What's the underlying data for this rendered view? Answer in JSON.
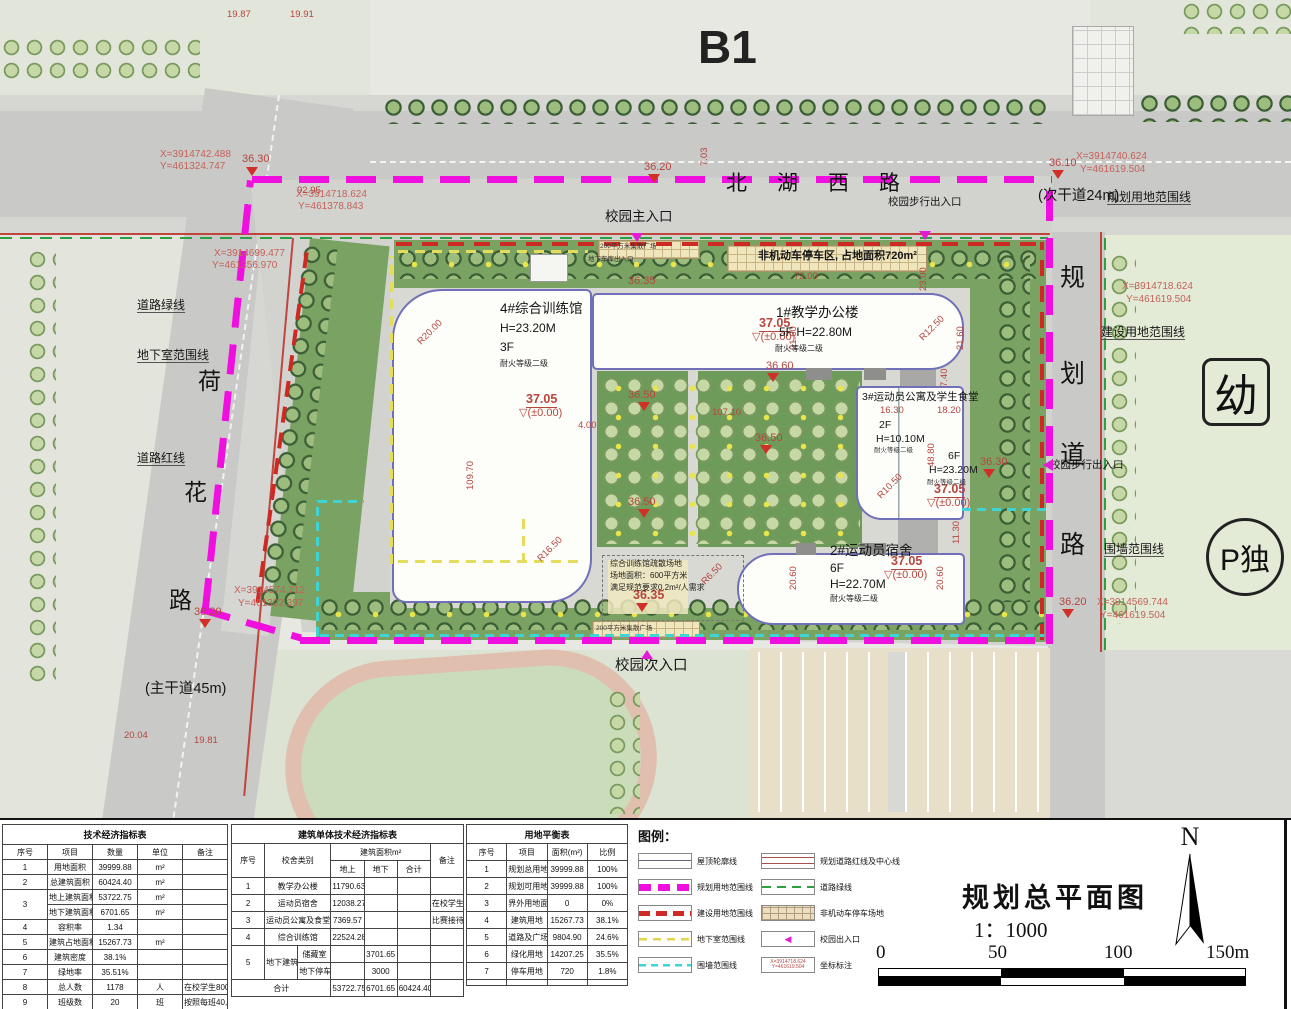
{
  "sheet": {
    "block_label": "B1",
    "title": "规划总平面图",
    "scale": "1：1000",
    "north": "N",
    "scale_ticks": [
      "0",
      "50",
      "100",
      "150m"
    ]
  },
  "plan": {
    "roads": {
      "north_name": "北湖西路",
      "north_note": "(次干道24m)",
      "west_note": "(主干道45m)"
    },
    "marks": {
      "kindergarten": "幼",
      "parking_island": "P独"
    },
    "annotations": [
      {
        "t": "X=3914742.488",
        "x": 160,
        "y": 150,
        "c": "rc"
      },
      {
        "t": "Y=461324.747",
        "x": 160,
        "y": 162,
        "c": "rc"
      },
      {
        "t": "X=3914718.624",
        "x": 296,
        "y": 190,
        "c": "rc"
      },
      {
        "t": "Y=461378.843",
        "x": 298,
        "y": 202,
        "c": "rc"
      },
      {
        "t": "X=3914699.477",
        "x": 214,
        "y": 249,
        "c": "rc"
      },
      {
        "t": "Y=461356.970",
        "x": 212,
        "y": 261,
        "c": "rc"
      },
      {
        "t": "X=3914740.624",
        "x": 1076,
        "y": 152,
        "c": "rc"
      },
      {
        "t": "Y=461619.504",
        "x": 1080,
        "y": 165,
        "c": "rc"
      },
      {
        "t": "X=3914718.624",
        "x": 1122,
        "y": 282,
        "c": "rc"
      },
      {
        "t": "Y=461619.504",
        "x": 1126,
        "y": 295,
        "c": "rc"
      },
      {
        "t": "X=3914574.712",
        "x": 234,
        "y": 586,
        "c": "rc"
      },
      {
        "t": "Y=461302.397",
        "x": 238,
        "y": 599,
        "c": "rc"
      },
      {
        "t": "X=3914569.744",
        "x": 1097,
        "y": 598,
        "c": "rc"
      },
      {
        "t": "Y=461619.504",
        "x": 1100,
        "y": 611,
        "c": "rc"
      },
      {
        "t": "36.30",
        "x": 242,
        "y": 154,
        "c": "r2"
      },
      {
        "t": "36.10",
        "x": 1049,
        "y": 158,
        "c": "r2"
      },
      {
        "t": "36.20",
        "x": 644,
        "y": 162,
        "c": "r2"
      },
      {
        "t": "36.60",
        "x": 766,
        "y": 361,
        "c": "r2"
      },
      {
        "t": "36.50",
        "x": 628,
        "y": 390,
        "c": "r2"
      },
      {
        "t": "36.50",
        "x": 755,
        "y": 433,
        "c": "r2"
      },
      {
        "t": "36.50",
        "x": 628,
        "y": 497,
        "c": "r2"
      },
      {
        "t": "36.30",
        "x": 980,
        "y": 457,
        "c": "r2"
      },
      {
        "t": "36.20",
        "x": 1059,
        "y": 597,
        "c": "r2"
      },
      {
        "t": "36.20",
        "x": 194,
        "y": 607,
        "c": "r2"
      },
      {
        "t": "36.35",
        "x": 628,
        "y": 276,
        "c": "r2"
      },
      {
        "t": "36.35",
        "x": 633,
        "y": 589,
        "c": "rb"
      },
      {
        "t": "37.05",
        "x": 526,
        "y": 393,
        "c": "rb u"
      },
      {
        "t": "▽(±0.00)",
        "x": 519,
        "y": 408,
        "c": "r2"
      },
      {
        "t": "37.05",
        "x": 759,
        "y": 317,
        "c": "rb u"
      },
      {
        "t": "▽(±0.00)",
        "x": 752,
        "y": 332,
        "c": "r2"
      },
      {
        "t": "37.05",
        "x": 934,
        "y": 483,
        "c": "rb u"
      },
      {
        "t": "▽(±0.00)",
        "x": 927,
        "y": 498,
        "c": "r2"
      },
      {
        "t": "37.05",
        "x": 891,
        "y": 555,
        "c": "rb u"
      },
      {
        "t": "▽(±0.00)",
        "x": 884,
        "y": 570,
        "c": "r2"
      },
      {
        "t": "19.87",
        "x": 227,
        "y": 10,
        "c": "r"
      },
      {
        "t": "19.91",
        "x": 290,
        "y": 10,
        "c": "r"
      },
      {
        "t": "92.95",
        "x": 297,
        "y": 186,
        "c": "r"
      },
      {
        "t": "7.03",
        "x": 700,
        "y": 166,
        "c": "r v"
      },
      {
        "t": "72.00",
        "x": 794,
        "y": 272,
        "c": "r"
      },
      {
        "t": "109.70",
        "x": 466,
        "y": 490,
        "c": "r v"
      },
      {
        "t": "21.60",
        "x": 789,
        "y": 350,
        "c": "r v"
      },
      {
        "t": "21.60",
        "x": 956,
        "y": 350,
        "c": "r v"
      },
      {
        "t": "7.40",
        "x": 940,
        "y": 387,
        "c": "r v"
      },
      {
        "t": "R20.00",
        "x": 416,
        "y": 340,
        "c": "r r45"
      },
      {
        "t": "R12.50",
        "x": 918,
        "y": 336,
        "c": "r r45"
      },
      {
        "t": "R16.50",
        "x": 536,
        "y": 557,
        "c": "r r45"
      },
      {
        "t": "R10.50",
        "x": 876,
        "y": 494,
        "c": "r r45"
      },
      {
        "t": "R6.50",
        "x": 700,
        "y": 580,
        "c": "r r45"
      },
      {
        "t": "16.30",
        "x": 880,
        "y": 406,
        "c": "r"
      },
      {
        "t": "18.20",
        "x": 937,
        "y": 406,
        "c": "r"
      },
      {
        "t": "48.80",
        "x": 927,
        "y": 467,
        "c": "r v"
      },
      {
        "t": "11.30",
        "x": 952,
        "y": 544,
        "c": "r v"
      },
      {
        "t": "20.60",
        "x": 789,
        "y": 590,
        "c": "r v"
      },
      {
        "t": "20.60",
        "x": 936,
        "y": 590,
        "c": "r v"
      },
      {
        "t": "20.04",
        "x": 124,
        "y": 731,
        "c": "r"
      },
      {
        "t": "19.81",
        "x": 194,
        "y": 736,
        "c": "r"
      },
      {
        "t": "107.10",
        "x": 712,
        "y": 408,
        "c": "r"
      },
      {
        "t": "4.00",
        "x": 578,
        "y": 421,
        "c": "r"
      },
      {
        "t": "23.00",
        "x": 919,
        "y": 291,
        "c": "r v"
      },
      {
        "t": "规划用地范围线",
        "x": 1107,
        "y": 191,
        "c": "k ldr",
        "n": "label-plan-boundary"
      },
      {
        "t": "校园步行出入口",
        "x": 888,
        "y": 197,
        "c": "k s10",
        "n": "label-pedestrian-entrance"
      },
      {
        "t": "校园主入口",
        "x": 605,
        "y": 210,
        "c": "k s13",
        "n": "label-main-entrance"
      },
      {
        "t": "(次干道24m)",
        "x": 1038,
        "y": 189,
        "c": "k s14",
        "n": "label-road-note"
      },
      {
        "t": "道路绿线",
        "x": 137,
        "y": 299,
        "c": "k ldr",
        "n": "label-road-greenline"
      },
      {
        "t": "地下室范围线",
        "x": 137,
        "y": 349,
        "c": "k ldr",
        "n": "label-basement-boundary"
      },
      {
        "t": "道路红线",
        "x": 137,
        "y": 452,
        "c": "k ldr",
        "n": "label-road-redline"
      },
      {
        "t": "(主干道45m)",
        "x": 145,
        "y": 682,
        "c": "k s14",
        "n": "label-road-note"
      },
      {
        "t": "建设用地范围线",
        "x": 1101,
        "y": 326,
        "c": "k ldr",
        "n": "label-construction-boundary"
      },
      {
        "t": "校园步行出入口",
        "x": 1050,
        "y": 460,
        "c": "k s10",
        "n": "label-pedestrian-entrance"
      },
      {
        "t": "围墙范围线",
        "x": 1104,
        "y": 543,
        "c": "k ldr",
        "n": "label-wall-boundary"
      },
      {
        "t": "校园次入口",
        "x": 615,
        "y": 659,
        "c": "k s14",
        "n": "label-secondary-entrance"
      },
      {
        "t": "荷",
        "x": 198,
        "y": 370,
        "c": "c24"
      },
      {
        "t": "花",
        "x": 184,
        "y": 481,
        "c": "c24"
      },
      {
        "t": "路",
        "x": 169,
        "y": 589,
        "c": "c24"
      },
      {
        "t": "规",
        "x": 1060,
        "y": 266,
        "c": "c26"
      },
      {
        "t": "划",
        "x": 1060,
        "y": 362,
        "c": "c26"
      },
      {
        "t": "道",
        "x": 1060,
        "y": 443,
        "c": "c26"
      },
      {
        "t": "路",
        "x": 1060,
        "y": 533,
        "c": "c26"
      },
      {
        "t": "200平方米集散广场",
        "x": 600,
        "y": 244,
        "c": "t7"
      },
      {
        "t": "地下车库出入口",
        "x": 588,
        "y": 257,
        "c": "t7"
      },
      {
        "t": "非机动车停车区, 占地面积720m²",
        "x": 758,
        "y": 251,
        "c": "k s11",
        "n": "label-bike-parking"
      },
      {
        "t": "200平方米集散广场",
        "x": 596,
        "y": 626,
        "c": "t7"
      },
      {
        "t": "综合训练馆疏散场地",
        "x": 610,
        "y": 560,
        "c": "s"
      },
      {
        "t": "场地面积：600平方米",
        "x": 610,
        "y": 572,
        "c": "s"
      },
      {
        "t": "满足规范要求0.2m²/人需求",
        "x": 610,
        "y": 584,
        "c": "s"
      },
      {
        "t": "4#综合训练馆",
        "x": 500,
        "y": 302,
        "c": "k s13",
        "n": "building-label"
      },
      {
        "t": "H=23.20M",
        "x": 500,
        "y": 322,
        "c": "k s12"
      },
      {
        "t": "3F",
        "x": 500,
        "y": 341,
        "c": "k s12"
      },
      {
        "t": "耐火等级二级",
        "x": 500,
        "y": 360,
        "c": "s"
      },
      {
        "t": "1#教学办公楼",
        "x": 776,
        "y": 306,
        "c": "k s13",
        "n": "building-label"
      },
      {
        "t": "5F  H=22.80M",
        "x": 779,
        "y": 326,
        "c": "k s12"
      },
      {
        "t": "耐火等级二级",
        "x": 775,
        "y": 345,
        "c": "s"
      },
      {
        "t": "3#运动员公寓及学生食堂",
        "x": 862,
        "y": 392,
        "c": "k s10",
        "n": "building-label"
      },
      {
        "t": "2F",
        "x": 879,
        "y": 420,
        "c": "k s10"
      },
      {
        "t": "H=10.10M",
        "x": 876,
        "y": 434,
        "c": "k s10"
      },
      {
        "t": "耐火等级二级",
        "x": 874,
        "y": 448,
        "c": "t7"
      },
      {
        "t": "6F",
        "x": 948,
        "y": 451,
        "c": "k s10"
      },
      {
        "t": "H=23.20M",
        "x": 929,
        "y": 465,
        "c": "k s10"
      },
      {
        "t": "耐火等级二级",
        "x": 927,
        "y": 480,
        "c": "t7"
      },
      {
        "t": "2#运动员宿舍",
        "x": 830,
        "y": 544,
        "c": "k s13",
        "n": "building-label"
      },
      {
        "t": "6F",
        "x": 830,
        "y": 562,
        "c": "k s12"
      },
      {
        "t": "H=22.70M",
        "x": 830,
        "y": 578,
        "c": "k s12"
      },
      {
        "t": "耐火等级二级",
        "x": 830,
        "y": 595,
        "c": "s"
      },
      {
        "t": "",
        "x": 246,
        "y": 167,
        "c": "tri"
      },
      {
        "t": "",
        "x": 1052,
        "y": 170,
        "c": "tri"
      },
      {
        "t": "",
        "x": 648,
        "y": 174,
        "c": "tri"
      },
      {
        "t": "",
        "x": 767,
        "y": 373,
        "c": "tri"
      },
      {
        "t": "",
        "x": 638,
        "y": 402,
        "c": "tri"
      },
      {
        "t": "",
        "x": 760,
        "y": 445,
        "c": "tri"
      },
      {
        "t": "",
        "x": 638,
        "y": 509,
        "c": "tri"
      },
      {
        "t": "",
        "x": 636,
        "y": 603,
        "c": "tri"
      },
      {
        "t": "",
        "x": 1062,
        "y": 609,
        "c": "tri"
      },
      {
        "t": "",
        "x": 199,
        "y": 619,
        "c": "tri"
      },
      {
        "t": "",
        "x": 983,
        "y": 469,
        "c": "tri"
      },
      {
        "t": "",
        "x": 631,
        "y": 233,
        "c": "tri m"
      },
      {
        "t": "",
        "x": 919,
        "y": 231,
        "c": "tri m"
      },
      {
        "t": "",
        "x": 1043,
        "y": 459,
        "c": "tri m left"
      },
      {
        "t": "",
        "x": 641,
        "y": 650,
        "c": "tri m up"
      }
    ]
  },
  "legend": {
    "title": "图例：",
    "left": [
      {
        "key": "roof",
        "label": "屋顶轮廓线"
      },
      {
        "key": "plan-bound",
        "label": "规划用地范围线"
      },
      {
        "key": "build-bound",
        "label": "建设用地范围线"
      },
      {
        "key": "basement",
        "label": "地下室范围线"
      },
      {
        "key": "wall",
        "label": "围墙范围线"
      }
    ],
    "right": [
      {
        "key": "road-red",
        "label": "规划道路红线及中心线"
      },
      {
        "key": "road-green",
        "label": "道路绿线"
      },
      {
        "key": "parking",
        "label": "非机动车停车场地"
      },
      {
        "key": "entrance",
        "label": "校园出入口",
        "glyph": "◀"
      },
      {
        "key": "coord",
        "label": "坐标标注",
        "lines": [
          "X=3914718.624",
          "Y=461619.504"
        ]
      }
    ]
  },
  "tables": [
    {
      "title": "技术经济指标表",
      "cols": 5,
      "header": [
        [
          "序号",
          "项目",
          "数量",
          "单位",
          "备注"
        ]
      ],
      "rows": [
        [
          "1",
          "用地面积",
          "39999.88",
          "m²",
          ""
        ],
        [
          "2",
          "总建筑面积",
          "60424.40",
          "m²",
          ""
        ],
        [
          {
            "t": "3",
            "rs": 2
          },
          "地上建筑面积",
          "53722.75",
          "m²",
          ""
        ],
        [
          "地下建筑面积",
          "6701.65",
          "m²",
          ""
        ],
        [
          "4",
          "容积率",
          "1.34",
          "",
          ""
        ],
        [
          "5",
          "建筑占地面积",
          "15267.73",
          "m²",
          ""
        ],
        [
          "6",
          "建筑密度",
          "38.1%",
          "",
          ""
        ],
        [
          "7",
          "绿地率",
          "35.51%",
          "",
          ""
        ],
        [
          "8",
          "总人数",
          "1178",
          "人",
          "在校学生800人，比赛228人"
        ],
        [
          "9",
          "班级数",
          "20",
          "班",
          "按照每班40人计"
        ],
        [
          "10",
          "机动车停车位",
          "30",
          "辆",
          "在校教师150人"
        ],
        [
          "11",
          "非机动车停车位",
          "412",
          "辆",
          ""
        ]
      ]
    },
    {
      "title": "建筑单体技术经济指标表",
      "cols": 7,
      "header": [
        [
          {
            "t": "序号",
            "rs": 2
          },
          {
            "t": "校舍类别",
            "rs": 2,
            "cs": 2
          },
          {
            "t": "建筑面积m²",
            "cs": 3
          },
          {
            "t": "备注",
            "rs": 2
          }
        ],
        [
          "地上",
          "地下",
          "合计"
        ]
      ],
      "rows": [
        [
          "1",
          {
            "t": "教学办公楼",
            "cs": 2
          },
          "11790.63",
          "",
          "",
          ""
        ],
        [
          "2",
          {
            "t": "运动员宿舍",
            "cs": 2
          },
          "12038.27",
          "",
          "",
          "在校学生800人"
        ],
        [
          "3",
          {
            "t": "运动员公寓及食堂",
            "cs": 2
          },
          "7369.57",
          "",
          "",
          "比赛接待228人"
        ],
        [
          "4",
          {
            "t": "综合训练馆",
            "cs": 2
          },
          "22524.28",
          "",
          "",
          ""
        ],
        [
          {
            "t": "5",
            "rs": 2
          },
          {
            "t": "地下建筑",
            "rs": 2
          },
          "储藏室",
          "",
          "3701.65",
          "",
          ""
        ],
        [
          "地下停车",
          "",
          "3000",
          "",
          ""
        ],
        [
          {
            "t": "合计",
            "cs": 3
          },
          "53722.75",
          "6701.65",
          "60424.40",
          ""
        ]
      ]
    },
    {
      "title": "用地平衡表",
      "cols": 4,
      "header": [
        [
          "序号",
          "项目",
          "面积(m²)",
          "比例"
        ]
      ],
      "rows": [
        [
          "1",
          "规划总用地面积",
          "39999.88",
          "100%"
        ],
        [
          "2",
          "规划可用地面积",
          "39999.88",
          "100%"
        ],
        [
          "3",
          "界外用地面积",
          "0",
          "0%"
        ],
        [
          "4",
          "建筑用地",
          "15267.73",
          "38.1%"
        ],
        [
          "5",
          "道路及广场用地",
          "9804.90",
          "24.6%"
        ],
        [
          "6",
          "绿化用地",
          "14207.25",
          "35.5%"
        ],
        [
          "7",
          "停车用地",
          "720",
          "1.8%"
        ],
        [
          "",
          "",
          "",
          ""
        ]
      ]
    }
  ]
}
